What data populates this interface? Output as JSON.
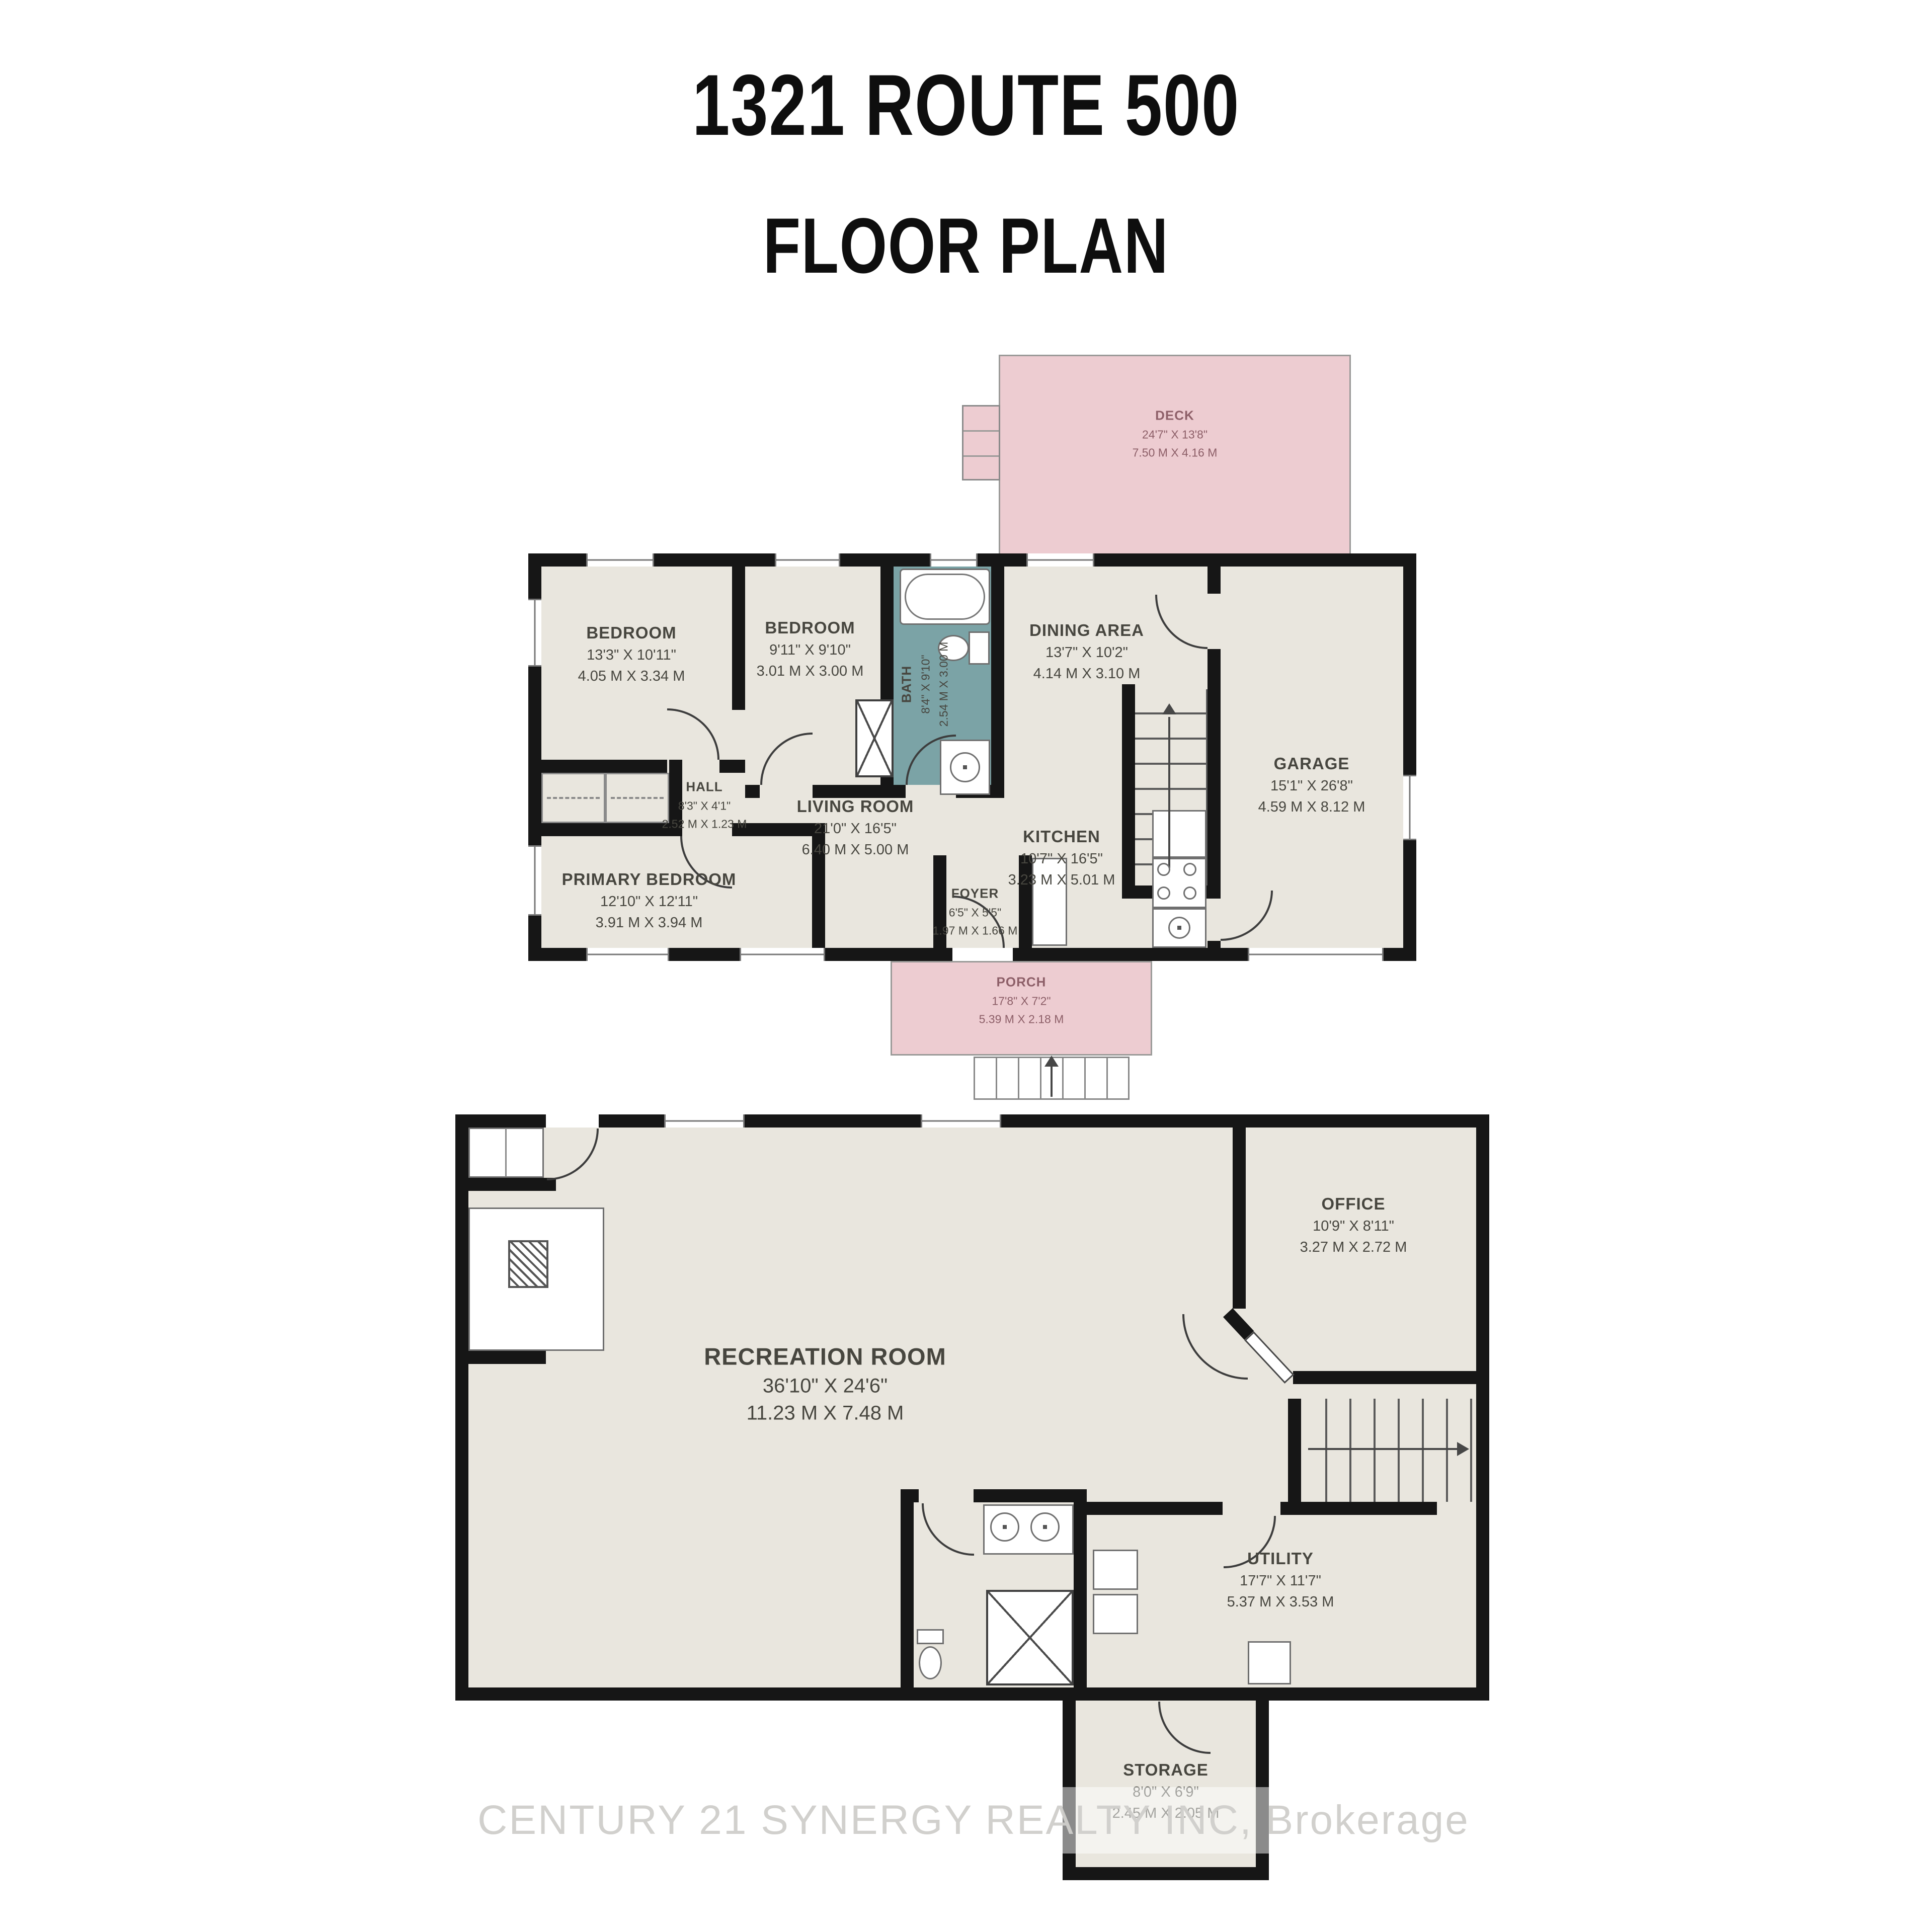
{
  "title": {
    "address": "1321 ROUTE 500",
    "subtitle": "FLOOR PLAN"
  },
  "watermark": "CENTURY 21 SYNERGY REALTY INC, Brokerage",
  "colors": {
    "wall": "#161616",
    "room_fill": "#e9e6de",
    "outdoor_fill": "#edccd1",
    "bath_fill": "#7ba3a6",
    "label": "#47463f",
    "outdoor_label": "#8d5f68",
    "watermark": "#cfcdca"
  },
  "floor1": {
    "name": "Main floor",
    "rooms": {
      "deck": {
        "name": "DECK",
        "imperial": "24'7\" X 13'8\"",
        "metric": "7.50 M X 4.16 M"
      },
      "bedroom1": {
        "name": "BEDROOM",
        "imperial": "13'3\" X 10'11\"",
        "metric": "4.05 M X 3.34 M"
      },
      "bedroom2": {
        "name": "BEDROOM",
        "imperial": "9'11\" X 9'10\"",
        "metric": "3.01 M X 3.00 M"
      },
      "bath": {
        "name": "BATH",
        "imperial": "8'4\" X 9'10\"",
        "metric": "2.54 M X 3.00 M"
      },
      "dining": {
        "name": "DINING AREA",
        "imperial": "13'7\" X 10'2\"",
        "metric": "4.14 M X 3.10 M"
      },
      "garage": {
        "name": "GARAGE",
        "imperial": "15'1\" X 26'8\"",
        "metric": "4.59 M X 8.12 M"
      },
      "hall": {
        "name": "HALL",
        "imperial": "8'3\" X 4'1\"",
        "metric": "2.52 M X 1.23 M"
      },
      "living": {
        "name": "LIVING ROOM",
        "imperial": "21'0\" X 16'5\"",
        "metric": "6.40 M X 5.00 M"
      },
      "kitchen": {
        "name": "KITCHEN",
        "imperial": "10'7\" X 16'5\"",
        "metric": "3.23 M X 5.01 M"
      },
      "primary": {
        "name": "PRIMARY BEDROOM",
        "imperial": "12'10\" X 12'11\"",
        "metric": "3.91 M X 3.94 M"
      },
      "foyer": {
        "name": "FOYER",
        "imperial": "6'5\" X 5'5\"",
        "metric": "1.97 M X 1.66 M"
      },
      "porch": {
        "name": "PORCH",
        "imperial": "17'8\" X 7'2\"",
        "metric": "5.39 M X 2.18 M"
      }
    }
  },
  "floor2": {
    "name": "Lower level",
    "rooms": {
      "rec": {
        "name": "RECREATION ROOM",
        "imperial": "36'10\" X 24'6\"",
        "metric": "11.23 M X 7.48 M"
      },
      "office": {
        "name": "OFFICE",
        "imperial": "10'9\" X 8'11\"",
        "metric": "3.27 M X 2.72 M"
      },
      "utility": {
        "name": "UTILITY",
        "imperial": "17'7\" X 11'7\"",
        "metric": "5.37 M X 3.53 M"
      },
      "storage": {
        "name": "STORAGE",
        "imperial": "8'0\" X 6'9\"",
        "metric": "2.45 M X 2.05 M"
      }
    }
  }
}
